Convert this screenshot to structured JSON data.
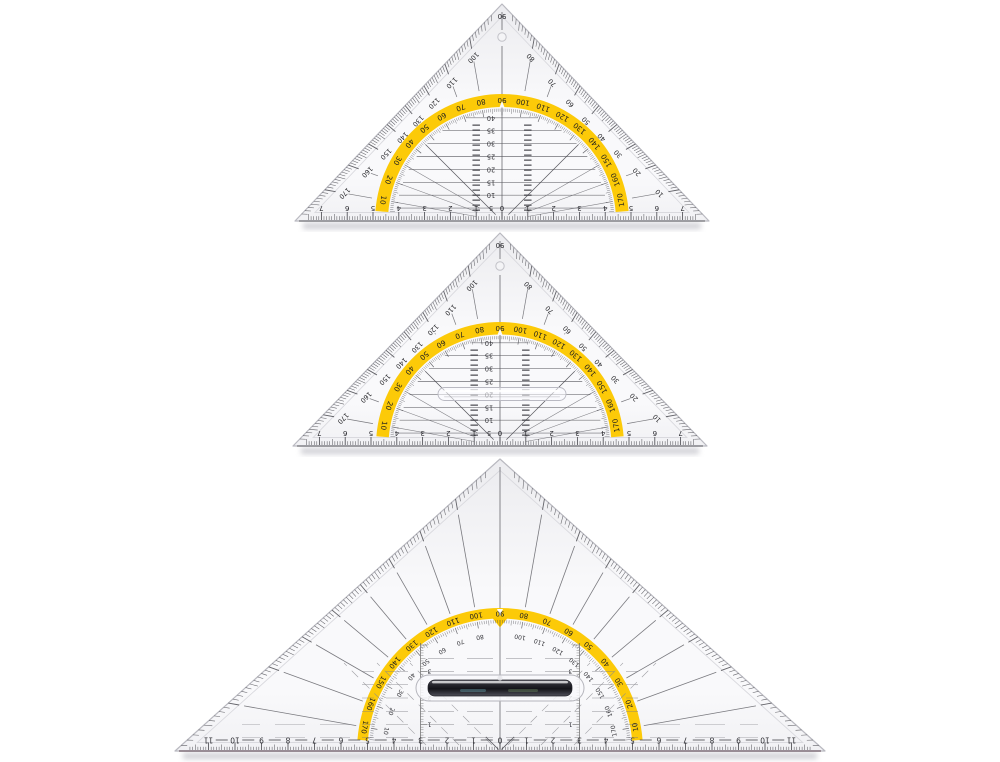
{
  "scene": {
    "background": "#ffffff",
    "title": "Three transparent Geodreieck set squares with yellow protractor scales",
    "text_orientation": "printed digits appear rotated 180 degrees"
  },
  "colors": {
    "band_yellow": "#fcc800",
    "ink": "#26262a",
    "tick": "#4a4a50",
    "line": "#5a5a60",
    "faint": "#8c8c92",
    "bevel": "#b9b9c0",
    "inset": "#d9d9de",
    "body_top": "#ececef",
    "body_mid": "#f9f9fb",
    "body_bot": "#f1f1f4",
    "shadow": "#a8a8b2",
    "ruler_edge_small": "#57575c",
    "ruler_edge_big": "#6e5a66",
    "handle_dark": "#1e1e24"
  },
  "triangles": [
    {
      "name": "set-square-top",
      "cx": 502,
      "baseY": 221,
      "halfBase": 207,
      "height": 217,
      "pxPerCm": 25.8,
      "arc": {
        "outerR": 127,
        "innerR": 114,
        "fineR": 111
      },
      "band_scale_direction": "ascending-left-to-right",
      "band_labels": [
        10,
        20,
        30,
        40,
        50,
        60,
        70,
        80,
        90,
        100,
        110,
        120,
        130,
        140,
        150,
        160,
        170
      ],
      "edge_labels": {
        "left": [
          170,
          160,
          150,
          140,
          130,
          120,
          110,
          100
        ],
        "apex": 90,
        "right": [
          80,
          70,
          60,
          50,
          40,
          30,
          20,
          10
        ]
      },
      "inner_scale": [
        5,
        10,
        15,
        20,
        25,
        30,
        35,
        40
      ],
      "ruler": {
        "numbers": [
          0,
          1,
          2,
          3,
          4,
          5,
          6,
          7
        ],
        "dashes": false
      },
      "hole": true,
      "handle": "none"
    },
    {
      "name": "set-square-middle",
      "cx": 500,
      "baseY": 446,
      "halfBase": 207,
      "height": 213,
      "pxPerCm": 25.8,
      "arc": {
        "outerR": 124,
        "innerR": 111.5,
        "fineR": 108.5
      },
      "band_scale_direction": "ascending-left-to-right",
      "band_labels": [
        10,
        20,
        30,
        40,
        50,
        60,
        70,
        80,
        90,
        100,
        110,
        120,
        130,
        140,
        150,
        160,
        170
      ],
      "edge_labels": {
        "left": [
          170,
          160,
          150,
          140,
          130,
          120,
          110,
          100
        ],
        "apex": 90,
        "right": [
          80,
          70,
          60,
          50,
          40,
          30,
          20,
          10
        ]
      },
      "inner_scale": [
        5,
        10,
        15,
        20,
        25,
        30,
        35,
        40
      ],
      "ruler": {
        "numbers": [
          0,
          1,
          2,
          3,
          4,
          5,
          6,
          7
        ],
        "dashes": false
      },
      "hole": true,
      "handle": "clear-bar"
    },
    {
      "name": "set-square-large",
      "cx": 500,
      "baseY": 751,
      "halfBase": 325,
      "height": 292,
      "pxPerCm": 26.5,
      "arc": {
        "outerR": 143,
        "innerR": 132.5,
        "fineR": 130
      },
      "band_scale_direction": "descending-left-to-right",
      "band_labels": [
        170,
        160,
        150,
        140,
        130,
        120,
        110,
        100,
        90,
        80,
        70,
        60,
        50,
        40,
        30,
        20,
        10
      ],
      "inner_arc_labels": [
        10,
        20,
        30,
        40,
        50,
        60,
        70,
        80,
        100,
        110,
        120,
        130,
        140,
        150,
        160,
        170
      ],
      "edge_labels": null,
      "columns": {
        "x_cm": 3,
        "numbers": [
          1,
          2,
          3
        ]
      },
      "ruler": {
        "numbers": [
          0,
          1,
          2,
          3,
          4,
          5,
          6,
          7,
          8,
          9,
          10,
          11
        ],
        "dashes": true
      },
      "hole": false,
      "handle": "grip-bar"
    }
  ]
}
